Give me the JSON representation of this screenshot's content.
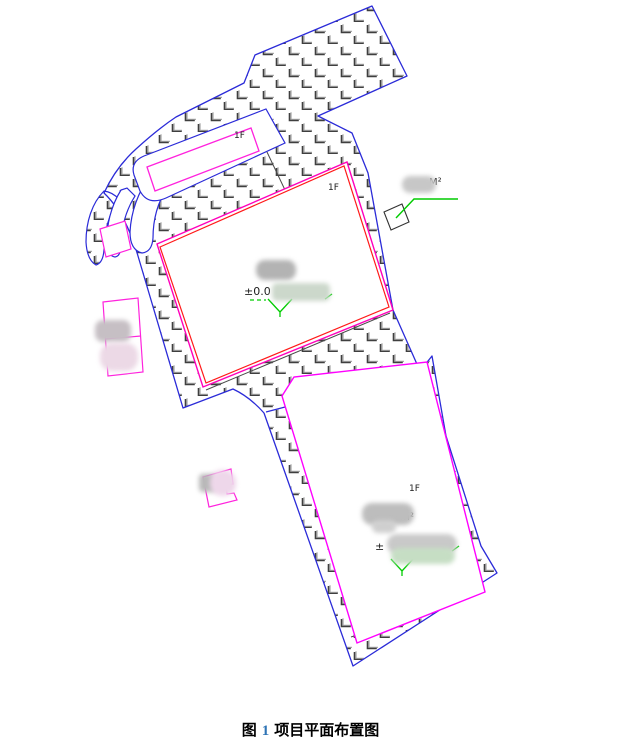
{
  "figure": {
    "caption": {
      "prefix": "图",
      "number": "1",
      "title": "项目平面布置图"
    }
  },
  "annotations": {
    "small_building": {
      "floor": "1F"
    },
    "building1": {
      "floor": "1F",
      "elevation": "±0.0"
    },
    "building2": {
      "floor": "1F",
      "area": "640m²",
      "elevation_prefix": "±"
    },
    "gatehouse": {
      "area_unit": "M²"
    }
  },
  "colors": {
    "boundary_blue": "#2b2bd8",
    "building1_outer_magenta": "#ff00bb",
    "building1_inner_red": "#ff1a1a",
    "building2_magenta": "#ff00ff",
    "small_structure_magenta": "#ff22dd",
    "annotation_green": "#00cc00",
    "hatch_dark": "#3f3f3f",
    "hatch_light": "#ababab",
    "caption_number_blue": "#2e74b5"
  }
}
